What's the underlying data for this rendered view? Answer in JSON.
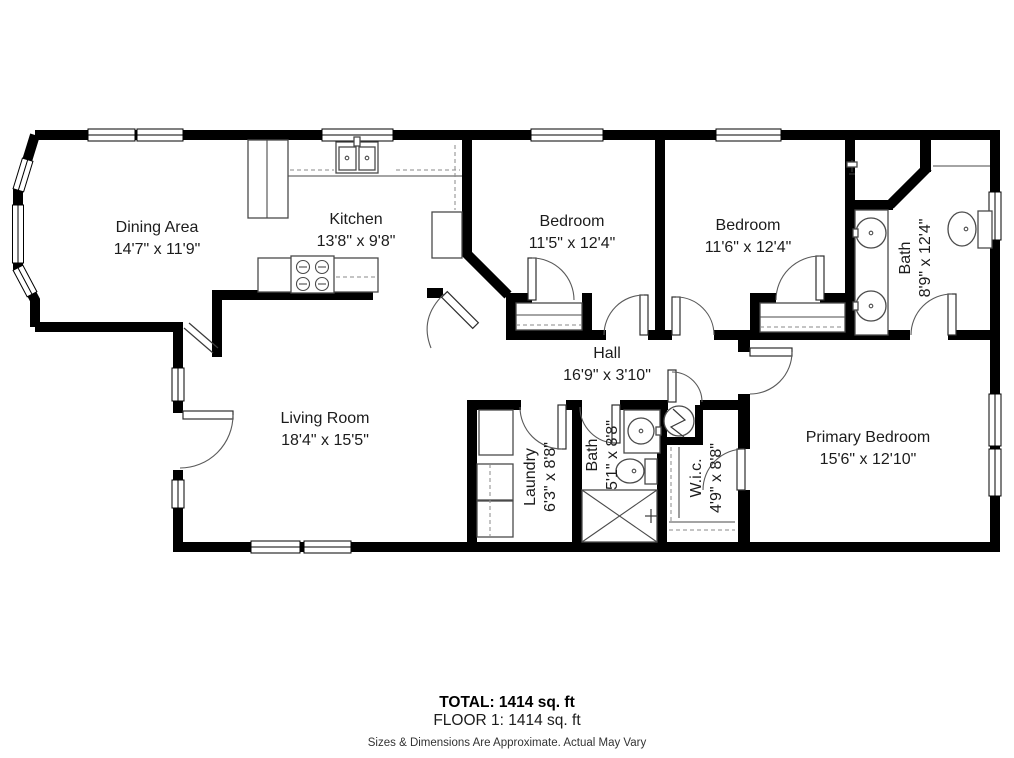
{
  "plan": {
    "rooms": {
      "dining": {
        "name": "Dining Area",
        "dims": "14'7\" x 11'9\""
      },
      "kitchen": {
        "name": "Kitchen",
        "dims": "13'8\" x 9'8\""
      },
      "bedroom1": {
        "name": "Bedroom",
        "dims": "11'5\" x 12'4\""
      },
      "bedroom2": {
        "name": "Bedroom",
        "dims": "11'6\" x 12'4\""
      },
      "bath1": {
        "name": "Bath",
        "dims": "8'9\" x 12'4\""
      },
      "hall": {
        "name": "Hall",
        "dims": "16'9\" x 3'10\""
      },
      "living": {
        "name": "Living Room",
        "dims": "18'4\" x 15'5\""
      },
      "laundry": {
        "name": "Laundry",
        "dims": "6'3\" x 8'8\""
      },
      "bath2": {
        "name": "Bath",
        "dims": "5'1\" x 8'8\""
      },
      "wic": {
        "name": "W.i.c.",
        "dims": "4'9\" x 8'8\""
      },
      "primary": {
        "name": "Primary Bedroom",
        "dims": "15'6\" x 12'10\""
      }
    },
    "summary": {
      "total": "TOTAL: 1414 sq. ft",
      "floor": "FLOOR 1: 1414 sq. ft",
      "disclaimer": "Sizes & Dimensions Are Approximate. Actual May Vary"
    },
    "colors": {
      "wall": "#000000",
      "background": "#ffffff",
      "text": "#1c1c1c"
    }
  }
}
